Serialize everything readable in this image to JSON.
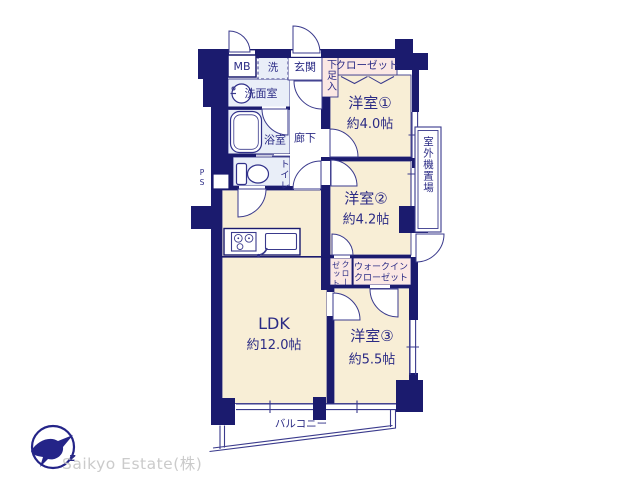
{
  "company": {
    "name": "Saikyo Estate(株)",
    "logo_letter": "z"
  },
  "rooms": {
    "ldk": {
      "label": "LDK",
      "size": "約12.0帖"
    },
    "room1": {
      "label": "洋室①",
      "size": "約4.0帖"
    },
    "room2": {
      "label": "洋室②",
      "size": "約4.2帖"
    },
    "room3": {
      "label": "洋室③",
      "size": "約5.5帖"
    }
  },
  "spaces": {
    "meter_box": "MB",
    "laundry": "洗",
    "entrance": "玄関",
    "shoe_box": "下足入",
    "closet": "クローゼット",
    "washroom": "洗面室",
    "bathroom": "浴室",
    "hallway": "廊下",
    "toilet": "トイレ",
    "pipe_space": "PS",
    "closet2_col1": "クロー",
    "closet2_col2": "ゼット",
    "wic_line1": "ウォークイン",
    "wic_line2": "クローゼット",
    "outdoor_unit": "室外機置場",
    "balcony": "バルコニー"
  },
  "colors": {
    "wall": "#1b1b6e",
    "thin_line": "#3a3a8c",
    "text": "#2b2b85",
    "room_fill": "#f8eed6",
    "wet_fill": "#e9eef8",
    "closet_fill": "#fbe8e4",
    "logo_text": "#cbcbcb"
  }
}
